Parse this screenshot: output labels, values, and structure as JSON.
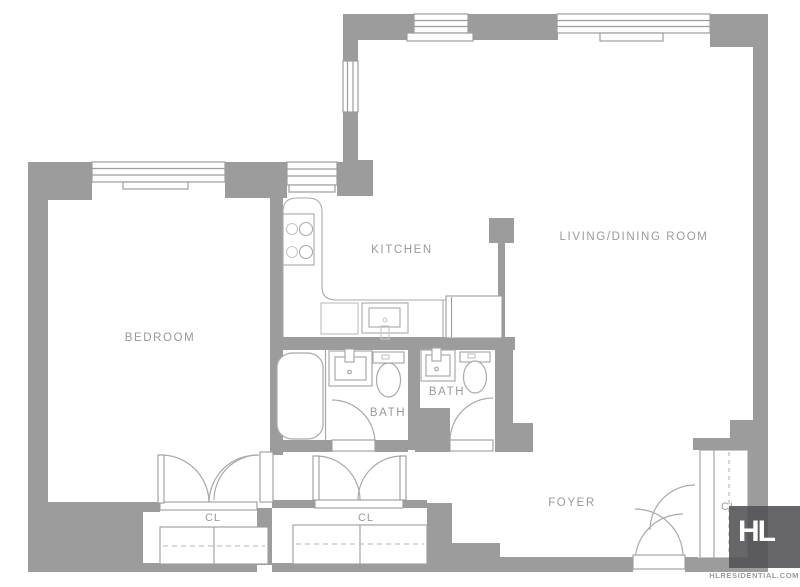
{
  "rooms": {
    "bedroom": "BEDROOM",
    "kitchen": "KITCHEN",
    "living_dining": "LIVING/DINING ROOM",
    "bath_1": "BATH",
    "bath_2": "BATH",
    "foyer": "FOYER",
    "closet_bedroom": "CL",
    "closet_hall": "CL",
    "closet_foyer": "CL"
  },
  "branding": {
    "logo_monogram": "HL",
    "website": "HLRESIDENTIAL.COM"
  },
  "colors": {
    "wall": "#9c9c9c",
    "fixture_line": "#a9a9a9",
    "light_line": "#c6c6c6",
    "label_text": "#9a9a9a",
    "logo_background": "#525255",
    "logo_text": "#ffffff"
  }
}
